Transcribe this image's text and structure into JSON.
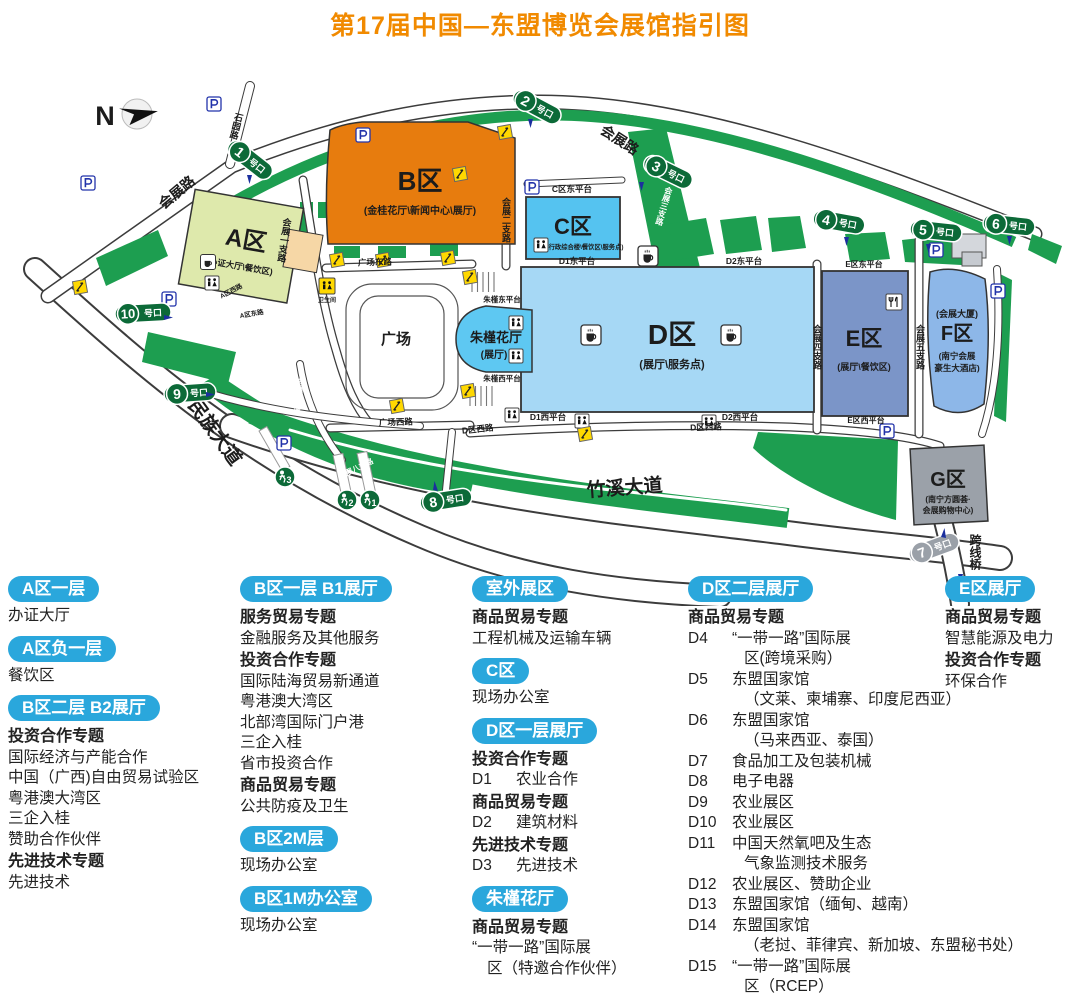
{
  "header": {
    "title": "第17届中国—东盟博览会展馆指引图"
  },
  "colors": {
    "title_orange": "#f18a00",
    "legend_badge_cyan": "#2aa7dc",
    "gate_green": "#0c6a38",
    "gate_gray": "#9aa0a8",
    "road_green": "#1d9e50",
    "area_a": "#dee9ac",
    "area_b": "#e77c0e",
    "area_c": "#55c3f0",
    "area_d": "#a6d8f5",
    "area_e": "#7b95c8",
    "area_f": "#8db7e8",
    "area_g": "#9ba1a9",
    "zhujin_hall": "#5ec8f2",
    "vip_tan": "#f6d7a6",
    "escalator_yellow": "#ffd800"
  },
  "map": {
    "compass": "N",
    "gate_suffix": "号口",
    "gates": {
      "g1": "1",
      "g2": "2",
      "g3": "3",
      "g4": "4",
      "g5": "5",
      "g6": "6",
      "g7": "7",
      "g8": "8",
      "g9": "9",
      "g10": "10"
    },
    "ped_gates": {
      "p1": "1",
      "p2": "2",
      "p3": "3"
    },
    "labels": {
      "huizhanlu_top": "会展路",
      "huizhanlu_left": "会展路",
      "shiyuanlu": "石园路",
      "hz1": "会展一支路",
      "hz2": "会展二支路",
      "hz3": "会展三支路",
      "hz4": "会展四支路",
      "hz5": "会展五支路",
      "hz7": "会展七支路",
      "hz8": "会展八支路",
      "minzu_avenue": "民族大道",
      "zhuxi_avenue": "竹溪大道",
      "kuaxianqiao": "跨线桥",
      "gc_dong": "广场东路",
      "gc_xi": "广场西路",
      "dqu_xilu": "D区西路",
      "d1_dong": "D1东平台",
      "d2_dong": "D2东平台",
      "c_dong": "C区东平台",
      "zj_dong": "朱槿东平台",
      "zj_xi": "朱槿西平台",
      "d1_xi": "D1西平台",
      "d2_xi": "D2西平台",
      "e_dong": "E区东平台",
      "e_xi": "E区西平台",
      "a_donglu": "A区东路",
      "a_xilu": "A区西路",
      "wc": "卫生间",
      "plaza": "广场"
    },
    "buildings": {
      "a": {
        "name": "A区",
        "sub": "(办证大厅\\餐饮区)"
      },
      "b": {
        "name": "B区",
        "sub": "(金桂花厅\\新闻中心\\展厅)"
      },
      "c": {
        "name": "C区",
        "sub": "(行政综合楼\\餐饮区\\服务点)"
      },
      "d": {
        "name": "D区",
        "sub": "(展厅\\服务点)"
      },
      "e": {
        "name": "E区",
        "sub": "(展厅\\餐饮区)"
      },
      "f": {
        "name": "F区",
        "sub1": "(会展大厦)",
        "sub2": "(南宁会展",
        "sub3": "豪生大酒店)"
      },
      "g": {
        "name": "G区",
        "sub1": "(南宁方圆荟·",
        "sub2": "会展购物中心)"
      },
      "zhujin": {
        "name": "朱槿花厅",
        "sub": "(展厅)"
      }
    }
  },
  "legend": {
    "col1": [
      {
        "type": "badge",
        "text": "A区一层"
      },
      {
        "type": "item",
        "text": "办证大厅"
      },
      {
        "type": "badge",
        "text": "A区负一层"
      },
      {
        "type": "item",
        "text": "餐饮区"
      },
      {
        "type": "badge",
        "text": "B区二层 B2展厅"
      },
      {
        "type": "bold",
        "text": "投资合作专题"
      },
      {
        "type": "item",
        "text": "国际经济与产能合作"
      },
      {
        "type": "item",
        "text": "中国（广西)自由贸易试验区"
      },
      {
        "type": "item",
        "text": "粤港澳大湾区"
      },
      {
        "type": "item",
        "text": "三企入桂"
      },
      {
        "type": "item",
        "text": "赞助合作伙伴"
      },
      {
        "type": "bold",
        "text": "先进技术专题"
      },
      {
        "type": "item",
        "text": "先进技术"
      }
    ],
    "col2": [
      {
        "type": "badge",
        "text": "B区一层 B1展厅"
      },
      {
        "type": "bold",
        "text": "服务贸易专题"
      },
      {
        "type": "item",
        "text": "金融服务及其他服务"
      },
      {
        "type": "bold",
        "text": "投资合作专题"
      },
      {
        "type": "item",
        "text": "国际陆海贸易新通道"
      },
      {
        "type": "item",
        "text": "粤港澳大湾区"
      },
      {
        "type": "item",
        "text": "北部湾国际门户港"
      },
      {
        "type": "item",
        "text": "三企入桂"
      },
      {
        "type": "item",
        "text": "省市投资合作"
      },
      {
        "type": "bold",
        "text": "商品贸易专题"
      },
      {
        "type": "item",
        "text": "公共防疫及卫生"
      },
      {
        "type": "badge",
        "text": "B区2M层"
      },
      {
        "type": "item",
        "text": "现场办公室"
      },
      {
        "type": "badge",
        "text": "B区1M办公室"
      },
      {
        "type": "item",
        "text": "现场办公室"
      }
    ],
    "col3": [
      {
        "type": "badge",
        "text": "室外展区"
      },
      {
        "type": "bold",
        "text": "商品贸易专题"
      },
      {
        "type": "item",
        "text": "工程机械及运输车辆"
      },
      {
        "type": "badge",
        "text": "C区"
      },
      {
        "type": "item",
        "text": "现场办公室"
      },
      {
        "type": "badge",
        "text": "D区一层展厅"
      },
      {
        "type": "bold",
        "text": "投资合作专题"
      },
      {
        "type": "item",
        "code": "D1",
        "text": "农业合作"
      },
      {
        "type": "bold",
        "text": "商品贸易专题"
      },
      {
        "type": "item",
        "code": "D2",
        "text": "建筑材料"
      },
      {
        "type": "bold",
        "text": "先进技术专题"
      },
      {
        "type": "item",
        "code": "D3",
        "text": "先进技术"
      },
      {
        "type": "badge",
        "text": "朱槿花厅"
      },
      {
        "type": "bold",
        "text": "商品贸易专题"
      },
      {
        "type": "item",
        "text": "“一带一路”国际展"
      },
      {
        "type": "cont",
        "text": "区（特邀合作伙伴）"
      }
    ],
    "col4": [
      {
        "type": "badge",
        "text": "D区二层展厅"
      },
      {
        "type": "bold",
        "text": "商品贸易专题"
      },
      {
        "type": "item",
        "code": "D4",
        "text": "“一带一路”国际展"
      },
      {
        "type": "cont2",
        "text": "区(跨境采购）"
      },
      {
        "type": "item",
        "code": "D5",
        "text": "东盟国家馆"
      },
      {
        "type": "cont2",
        "text": "（文莱、柬埔寨、印度尼西亚）"
      },
      {
        "type": "item",
        "code": "D6",
        "text": "东盟国家馆"
      },
      {
        "type": "cont2",
        "text": "（马来西亚、泰国）"
      },
      {
        "type": "item",
        "code": "D7",
        "text": "食品加工及包装机械"
      },
      {
        "type": "item",
        "code": "D8",
        "text": "电子电器"
      },
      {
        "type": "item",
        "code": "D9",
        "text": "农业展区"
      },
      {
        "type": "item",
        "code": "D10",
        "text": "农业展区"
      },
      {
        "type": "item",
        "code": "D11",
        "text": "中国天然氧吧及生态"
      },
      {
        "type": "cont2",
        "text": "气象监测技术服务"
      },
      {
        "type": "item",
        "code": "D12",
        "text": "农业展区、赞助企业"
      },
      {
        "type": "item",
        "code": "D13",
        "text": "东盟国家馆（缅甸、越南）"
      },
      {
        "type": "item",
        "code": "D14",
        "text": "东盟国家馆"
      },
      {
        "type": "cont2",
        "text": "（老挝、菲律宾、新加坡、东盟秘书处）"
      },
      {
        "type": "item",
        "code": "D15",
        "text": "“一带一路”国际展"
      },
      {
        "type": "cont2",
        "text": "区（RCEP）"
      }
    ],
    "col5": [
      {
        "type": "badge",
        "text": "E区展厅"
      },
      {
        "type": "bold",
        "text": "商品贸易专题"
      },
      {
        "type": "item",
        "text": "智慧能源及电力"
      },
      {
        "type": "bold",
        "text": "投资合作专题"
      },
      {
        "type": "item",
        "text": "环保合作"
      }
    ]
  }
}
